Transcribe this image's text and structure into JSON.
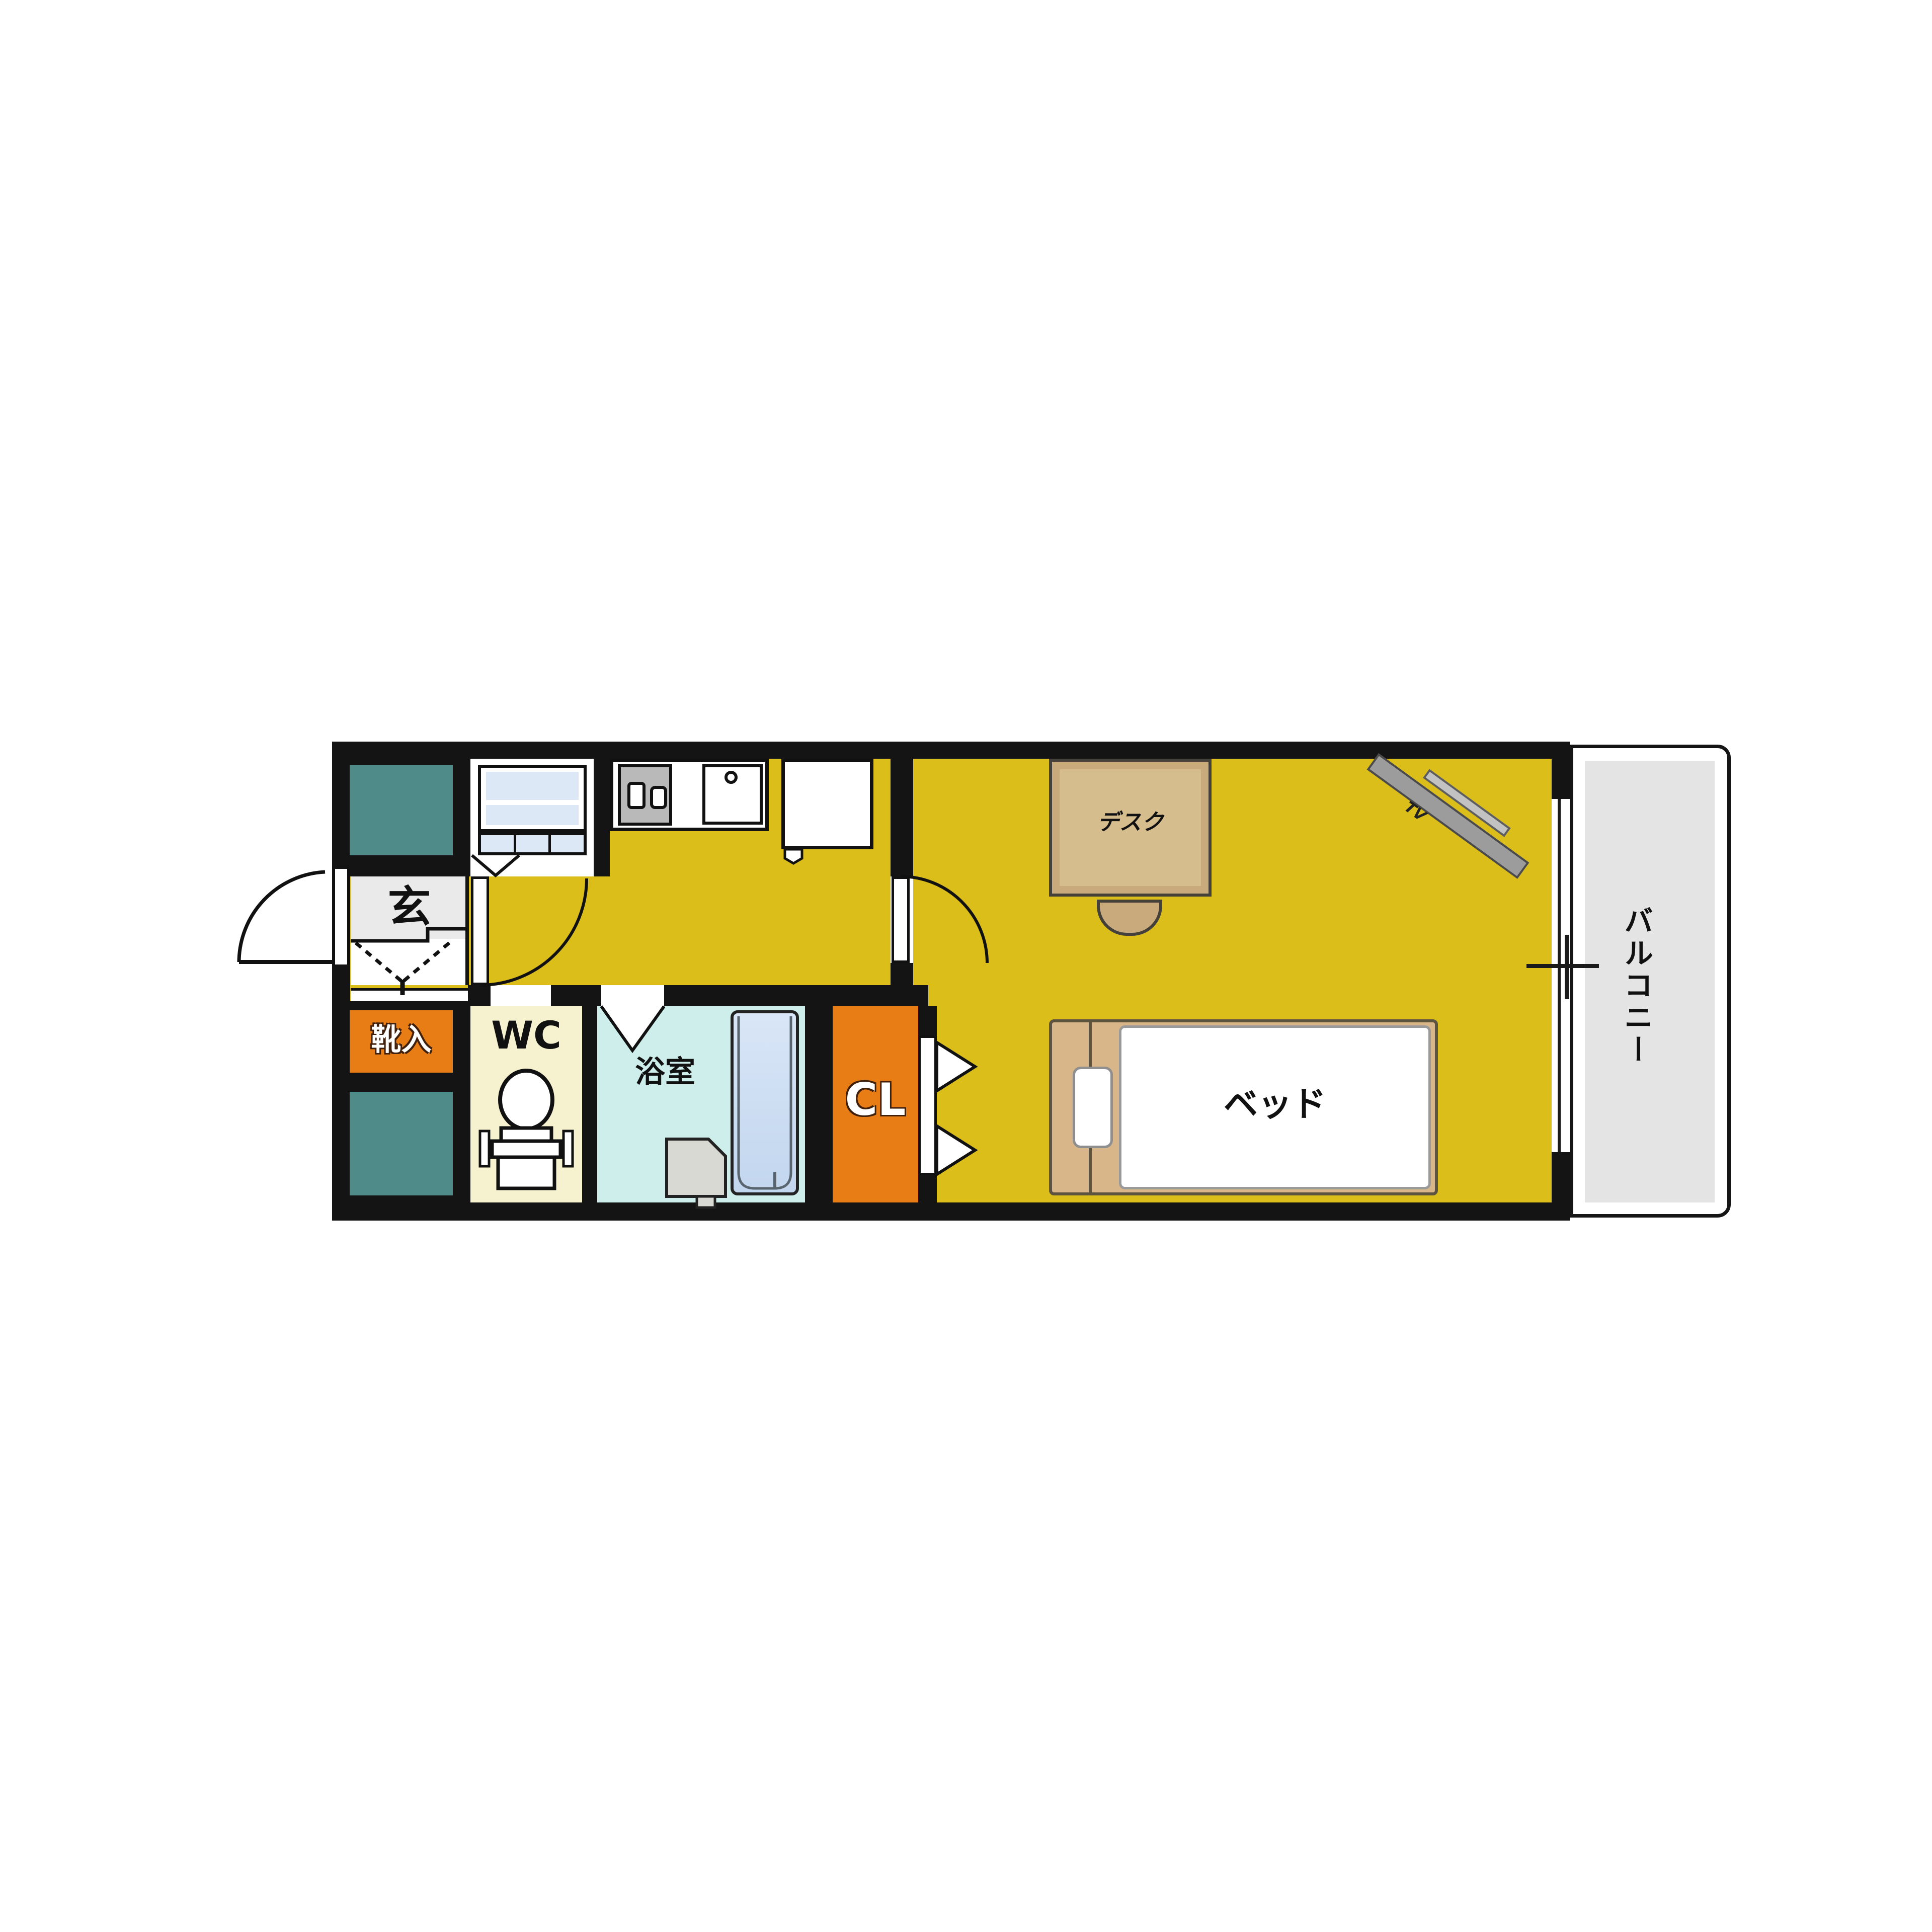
{
  "floor_plan": {
    "type": "japanese-apartment-1K-floor-plan",
    "rooms": {
      "entrance": {
        "label": "玄"
      },
      "shoe_cabinet": {
        "label": "靴入"
      },
      "toilet": {
        "label": "WC"
      },
      "bathroom": {
        "label": "浴室"
      },
      "closet": {
        "label": "CL"
      },
      "balcony": {
        "label": "バルコニー"
      }
    },
    "furniture": {
      "desk": {
        "label": "デスク"
      },
      "bed": {
        "label": "ベッド"
      },
      "tv": {
        "label": "TV"
      }
    },
    "fixtures": [
      "pipe-space-upper",
      "pipe-space-lower",
      "washing-machine-space",
      "stove",
      "kitchen-sink",
      "refrigerator-space",
      "toilet-bowl",
      "bathtub",
      "washbasin",
      "entrance-door",
      "kitchen-door",
      "room-door",
      "closet-folding-door",
      "bathroom-folding-door",
      "balcony-window"
    ],
    "colors": {
      "wall": "#141414",
      "flooring": "#dcbe1b",
      "entrance_floor": "#eaeaea",
      "shoe_cabinet": "#e87d15",
      "closet": "#e87d15",
      "toilet_room": "#f6f2cf",
      "bathroom": "#cdeeea",
      "bathtub": "#c9dcf2",
      "washer_panel": "#dce8f6",
      "pipe_space": "#4f8b89",
      "balcony_floor": "#e4e4e4",
      "furniture_wood": "#c8aa7c",
      "bed_frame": "#d8b689",
      "tv_gray": "#9c9c9c"
    }
  }
}
